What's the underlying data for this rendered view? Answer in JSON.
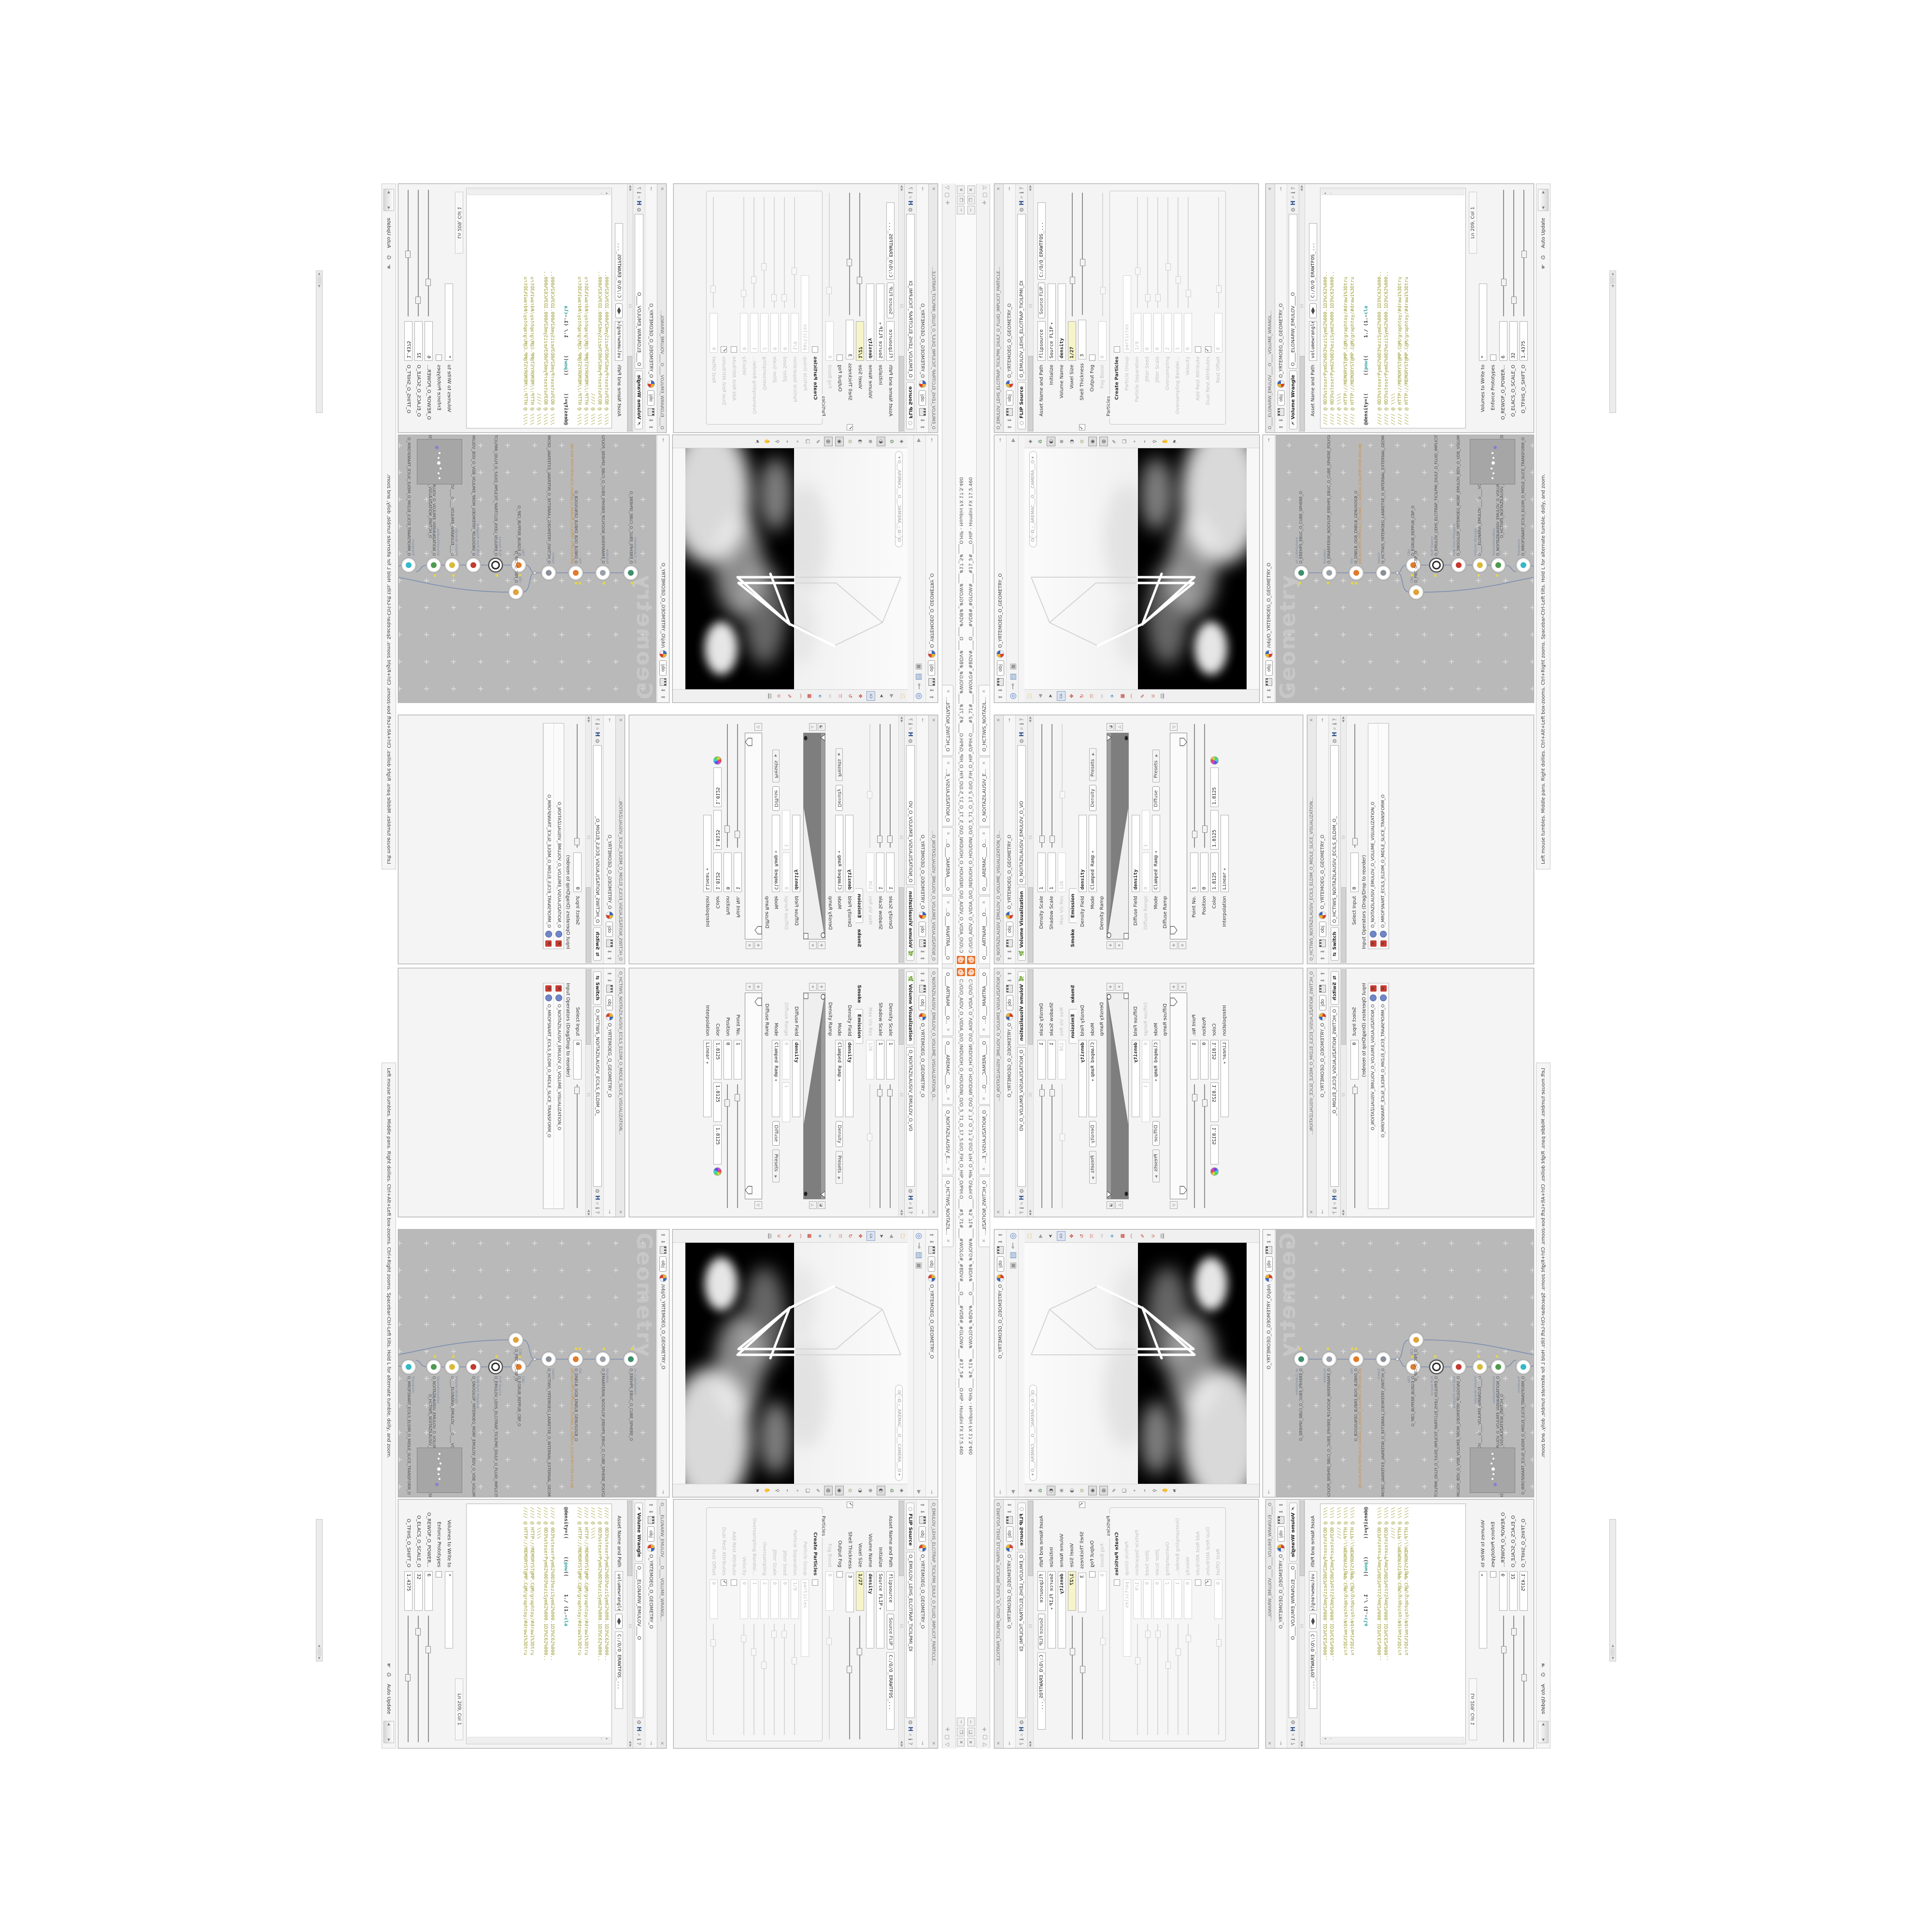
{
  "main_window": {
    "title": "C:/O/O_AIDV_O_VIDIA_0/O_INIDUOH_O_HOUDINI_O/O_5_71_O_17_5.0/O_FIH_O_HIP_O/PIH.O____#5_71#____#WOLG#_#BDV#____O____#VDB#_#GLOW#____#17_5#____O.HIP - Houdini FX 17.5.460",
    "minimize": "─",
    "maximize": "❐",
    "close": "✕"
  },
  "tab_bar": {
    "tabs": [
      {
        "label": "O____ARTNAM____O...",
        "close": "✕"
      },
      {
        "label": "O____AREMAC____O...",
        "close": "✕"
      },
      {
        "label": "O_NOITAZILAUSIV_E...",
        "close": "✕"
      },
      {
        "label": "O_HCTIWS_NOITAZIL...",
        "close": "✕"
      }
    ],
    "pane_icons": [
      "✛",
      "▢",
      "▽"
    ]
  },
  "common": {
    "obj_chip": "obj",
    "geometry_path": "O_YRTEMOEG_O_GEOMETRY_O",
    "software_path": "C:/O/O_ERAWTFOS_...",
    "asset_label": "Asset Name and Path",
    "up": "⬆",
    "down": "⬇",
    "pin": "⊸",
    "lr": "◀▶",
    "gear": "⚙",
    "h_logo": "H",
    "info": "ℹ",
    "help": "?",
    "mag": "⌕"
  },
  "volume_visualization": {
    "window_title": "O_NOITAZILAUSIV_EMULOV_O_VOLUME_VISUALIZATION_O...",
    "tab": "Volume Visualization",
    "name_field": "O_NOITAZILAUSIV_EMULOV_O_VO",
    "density_scale": {
      "label": "Density Scale",
      "value": "1"
    },
    "shadow_scale": {
      "label": "Shadow Scale",
      "value": "1"
    },
    "max_vis_res": {
      "label": "Max Vis Res",
      "value": "128"
    },
    "folder_tabs": {
      "smoke": "Smoke",
      "emission": "Emission"
    },
    "density_field": {
      "label": "Density Field",
      "value": "density"
    },
    "mode1": {
      "label": "Mode",
      "value": "Clamped Ramp",
      "chip": "Density",
      "presets": "Presets"
    },
    "density_ramp_label": "Density Ramp",
    "diffuse_field": {
      "label": "Diffuse Field",
      "value": "density"
    },
    "diffuse_range": {
      "label": "Diffuse Range",
      "v1": "0",
      "v2": "1"
    },
    "mode2": {
      "label": "Mode",
      "value": "Clamped Ramp",
      "chip": "Diffuse",
      "presets": "Presets"
    },
    "diffuse_ramp_label": "Diffuse Ramp",
    "point_no": {
      "label": "Point No.",
      "value": "1"
    },
    "position": {
      "label": "Position",
      "value": "0"
    },
    "color": {
      "label": "Color",
      "v1": "1.8125",
      "v2": "1.8125",
      "v3": "1.8125"
    },
    "interpolation": {
      "label": "Interpolation",
      "value": "Linear"
    }
  },
  "switch_window": {
    "window_title": "O_HCTIWS_NOITAZILAUSIV_ECILS_ELDIM_O_MIDLE_SLICE_VISUALIZATION...",
    "tab": "Switch",
    "name_field": "O_HCTIWS_NOITAZILAUSIV_ECILS_ELDIM_O_",
    "select_input": {
      "label": "Select Input",
      "value": "0"
    },
    "list_label": "Input Operators (Drag/Drop to reorder)",
    "items": [
      "O_NOITAZILAUSIV_EMULOV_O_VOLUME_VISUALIZATION_O",
      "O_MROFSNART_ECILS_ELDIM_O_MIDLE_SLICE_TRANSFORM_O"
    ]
  },
  "viewport": {
    "ortho_pill": "Ortho",
    "camera_pill": "O___AREMAC___O___CAMERA___O",
    "menu_arrow": "▾"
  },
  "network": {
    "breadcrumb": "/obj/O_YRTEMOEG_O_GEOMETRY_O",
    "watermark": "Geometry",
    "file_path_badge": "JRD.N03.PETS.TRPOLS.O_SSURBG_O_GENASS_O.SLOP.BT.STER.3D4.OBJ",
    "nodes": [
      {
        "sub": "an_CubeSphere",
        "name": "O_EREHPS_EBUC_O_CUBE_SPHERE_O"
      },
      {
        "sub": "PolyWire",
        "name": "O_EMARFERIW_NOGYLOP_EREHPS_EBUC_O_CUBE_SPHERE_POLYGON_WIREFRAME_O"
      },
      {
        "sub": "File",
        "name": "O_DNELB_OGB_DNELB_GENUSOGB_O"
      },
      {
        "sub": "Switch",
        "name": "O_HCTIWS_YRTEMOEG_LANRETXE_O_INTERNAL_EXTERNAL_GEOMETRY_SWITCH_O"
      },
      {
        "sub": "CBp",
        "name": "O_EGRUB_REPPUB_CBP_O"
      },
      {
        "sub": "FLIP Source",
        "name": "O_EMULOV_LEHS_ELCITRAP_TICILPMI_DIULF_O_FLUID_IMPLICIT_PARTICLE_SHEL_VOLUME_O"
      },
      {
        "sub": "VDB from Polygons",
        "name": "O_SNOGILOP_YRTEMOEG_MORF_EMULOV_BDV_O_VDB_VOLUME_FROM_GEOMETRY_POLYG"
      },
      {
        "sub": "Volume Wrangle",
        "name": "O____ELGNARW_EMULOV____O____VOLUME_WRANGLE____O"
      },
      {
        "sub": "VolumeVisualiza",
        "name": "O_NOITAZILAUSIV_EMULOV_O_VOLUME_VISUALIZATION_O"
      },
      {
        "sub": "Transform",
        "name": "O_MROFSNART_ECILS_ELDIM_O_MIDLE_SLICE_TRANSFORM_O"
      },
      {
        "sub": "Switch",
        "name": "O_HCTIWS_NOITAZILAUSIV_ECILS_ELDIM_O_MIDLE_SLICE_VISUALIZATION_SWITCH_O"
      },
      {
        "sub": "Merge",
        "name": "O_ECAFRUS_HTIW_EMULOV_EGREM_O_MERGE_VOLUME_WITH_SURFACE_O"
      },
      {
        "sub": "Transform",
        "name": "O_MROFSNART_TLUSER_O_RESULT_TRANSFORM_O"
      },
      {
        "sub": "CBp",
        "name": "O_PBC_O_CBP_O"
      }
    ],
    "status_text": "Left mouse tumbles. Middle pans. Right dollies. Ctrl+Alt+Left box-zooms. Ctrl+Right zooms. Spacebar-Ctrl-Left tilts. Hold L for alternate tumble, dolly, and zoom.",
    "auto_update": "Auto Update"
  },
  "flip_source": {
    "window_title": "O_EMULOV_LEHS_ELCITRAP_TICILPMI_DIULF_O_FLUID_IMPLICIT_PARTICLE...",
    "tab": "FLIP Source",
    "name_field": "O_EMULOV_LEHS_ELCITRAP_TICILPMI_DI",
    "asset_value": "flipsource",
    "asset_chip": "Source FLIP",
    "initialize": {
      "label": "Initialize",
      "value": "Source FLIP"
    },
    "volume_name": {
      "label": "Volume Name",
      "value": "density"
    },
    "voxel_size": {
      "label": "Voxel Size",
      "value": "1/27"
    },
    "shell_thickness": {
      "label": "Shell Thickness",
      "value": "3"
    },
    "output_fog": {
      "label": "Output Fog"
    },
    "fog_boost": {
      "label": "Fog Boost",
      "value": "0"
    },
    "particles_group": "Particles",
    "create_particles": "Create Particles",
    "particle_group": {
      "label": "Particle Group",
      "value": "particles"
    },
    "particle_separation": {
      "label": "Particle Separation",
      "value": "1/9"
    },
    "jitter_seed": {
      "label": "Jitter Seed",
      "value": "0"
    },
    "jitter_scale": {
      "label": "Jitter Scale",
      "value": "0"
    },
    "oversampling": {
      "label": "Oversampling",
      "value": "2"
    },
    "oversampling_bw": {
      "label": "Oversampling Bandwi...",
      "value": "1"
    },
    "velocity": {
      "label": "Velocity",
      "value": "0"
    },
    "add_rest": "Add Rest Attribute",
    "dual_rest": "Dual Rest Attributes",
    "rest_offset": {
      "label": "Rest Offset",
      "value": "0"
    }
  },
  "volume_wrangle": {
    "window_title": "O____ELGNARW_EMULOV____O____VOLUME_WRANGL...",
    "tab": "Volume Wrangle",
    "name_field": "O____ELGNARW_EMULOV____O",
    "asset_value": "volumewrangle",
    "code_block": [
      "//// @ 0D3%steserPym62%0D3%eziSym62%000.1D3%C62%000..",
      "//// @ 0D3%steserPym62%0D3%eziSym62%000.1D3%C62%000..",
      "//// @ \\\\\\\\",
      "//// @ HTTP://MEMORYST@MP.C@M/graphtoy/#draw1%3Dtru",
      "//// @ HTTP://MEMORYST@MP.C@M/graphtoy/#draw1%3Dtru"
    ],
    "density_line": {
      "a": "@density=((      ((",
      "pow": "pow",
      "b": "((      1./ (1.-",
      "c": "cla"
    },
    "ln_col": "Ln 209, Col 1",
    "volumes_label": "Volumes to Write to",
    "volumes_value": "*",
    "enforce": "Enforce Prototypes",
    "sliders": [
      {
        "label": "O_REWOP_O_POWER...",
        "value": "6"
      },
      {
        "label": "O_ELACS_O_SCALE_O",
        "value": "32"
      },
      {
        "label": "O_TFIHS_O_SHIFT_O",
        "value": "1.4375"
      }
    ]
  },
  "colors": {
    "accent_orange": "#e8702a",
    "selection_outer": "#5b6aaa",
    "selection_inner": "#b7a6e8",
    "code_olive": "#9a9a30",
    "code_keyword_teal": "#2e9e9e",
    "flag_yellow": "#e8d44c",
    "keyframe_yellow": "#f6f4c8",
    "network_canvas": "#b9b9b9"
  }
}
